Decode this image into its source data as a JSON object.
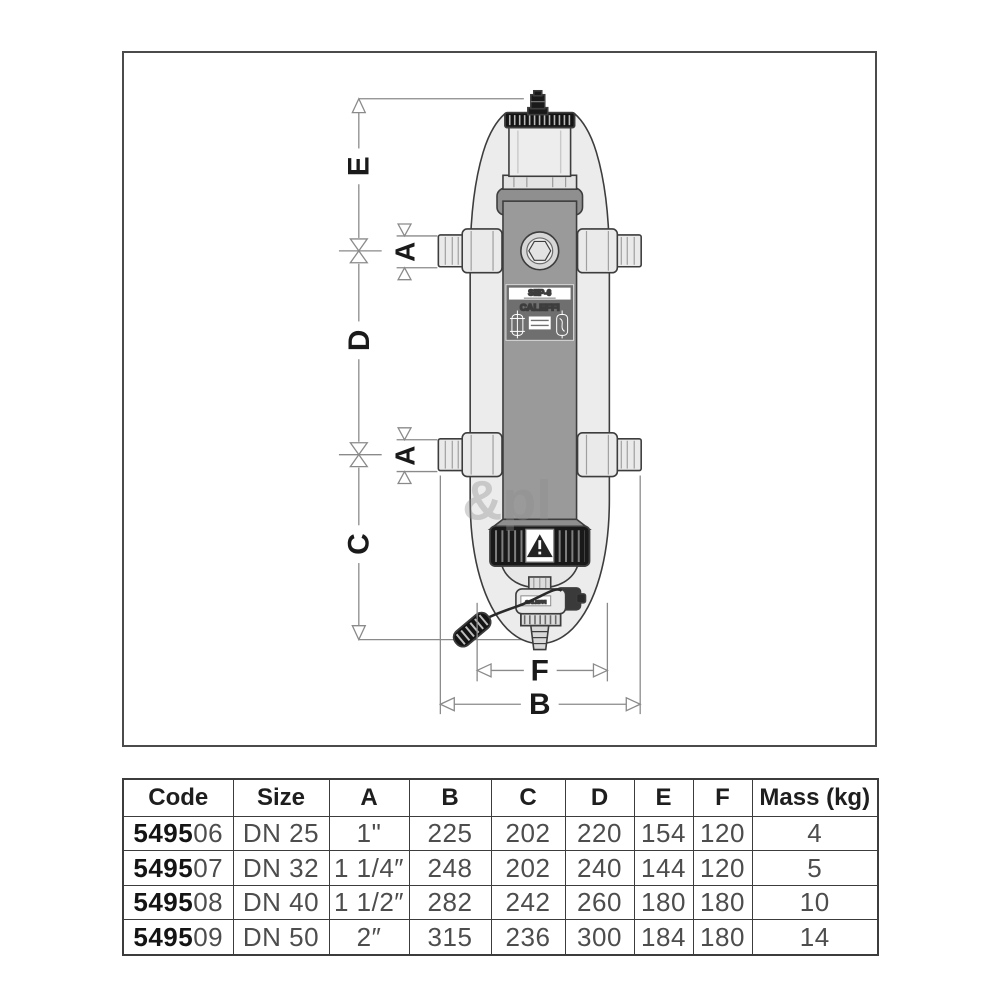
{
  "drawing": {
    "dims": {
      "e": "E",
      "d": "D",
      "c": "C",
      "a": "A",
      "f": "F",
      "b": "B"
    },
    "device_label": {
      "model": "SEP-6",
      "brand": "CALEFFI"
    },
    "valve_brand": "CALEFFI",
    "watermark": "&pl",
    "icons": {
      "warning": "warning-triangle-icon",
      "dim_arrows": "open-triangle-arrow-icon",
      "level_marker": "bowtie-level-marker-icon"
    },
    "colors": {
      "outline": "#3d3d3d",
      "shell_gray": "#ececec",
      "body_gray": "#9a9a9a",
      "label_gray": "#6f6f6f",
      "black_part": "#191919",
      "dim_line": "#8a8a8a"
    }
  },
  "table": {
    "headers": [
      "Code",
      "Size",
      "A",
      "B",
      "C",
      "D",
      "E",
      "F",
      "Mass (kg)"
    ],
    "rows": [
      {
        "code_prefix": "5495",
        "code_suffix": "06",
        "size": "DN 25",
        "a": "1\"",
        "b": "225",
        "c": "202",
        "d": "220",
        "e": "154",
        "f": "120",
        "mass": "4"
      },
      {
        "code_prefix": "5495",
        "code_suffix": "07",
        "size": "DN 32",
        "a": "1 1/4″",
        "b": "248",
        "c": "202",
        "d": "240",
        "e": "144",
        "f": "120",
        "mass": "5"
      },
      {
        "code_prefix": "5495",
        "code_suffix": "08",
        "size": "DN 40",
        "a": "1 1/2″",
        "b": "282",
        "c": "242",
        "d": "260",
        "e": "180",
        "f": "180",
        "mass": "10"
      },
      {
        "code_prefix": "5495",
        "code_suffix": "09",
        "size": "DN 50",
        "a": "2″",
        "b": "315",
        "c": "236",
        "d": "300",
        "e": "184",
        "f": "180",
        "mass": "14"
      }
    ]
  }
}
